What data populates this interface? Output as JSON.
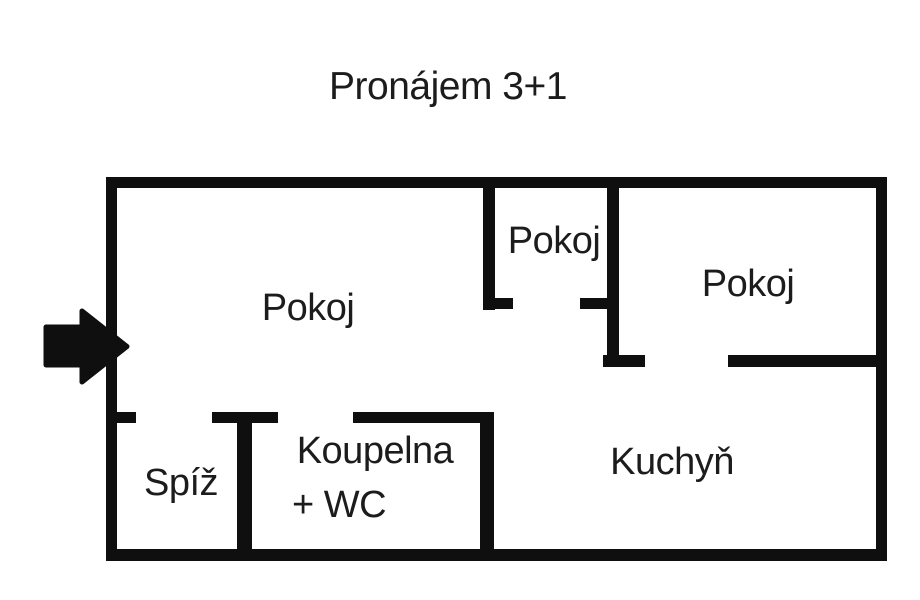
{
  "title": "Pronájem 3+1",
  "labels": {
    "room_pokoj_large": "Pokoj",
    "room_pokoj_small": "Pokoj",
    "room_pokoj_right": "Pokoj",
    "room_spiz": "Spíž",
    "room_koupelna_line1": "Koupelna",
    "room_koupelna_line2": "+ WC",
    "room_kuchyn": "Kuchyň"
  },
  "icons": {
    "entrance_arrow": "right-block-arrow"
  },
  "colors": {
    "background": "#ffffff",
    "wall": "#0f0f0f",
    "text": "#1c1c1c"
  }
}
